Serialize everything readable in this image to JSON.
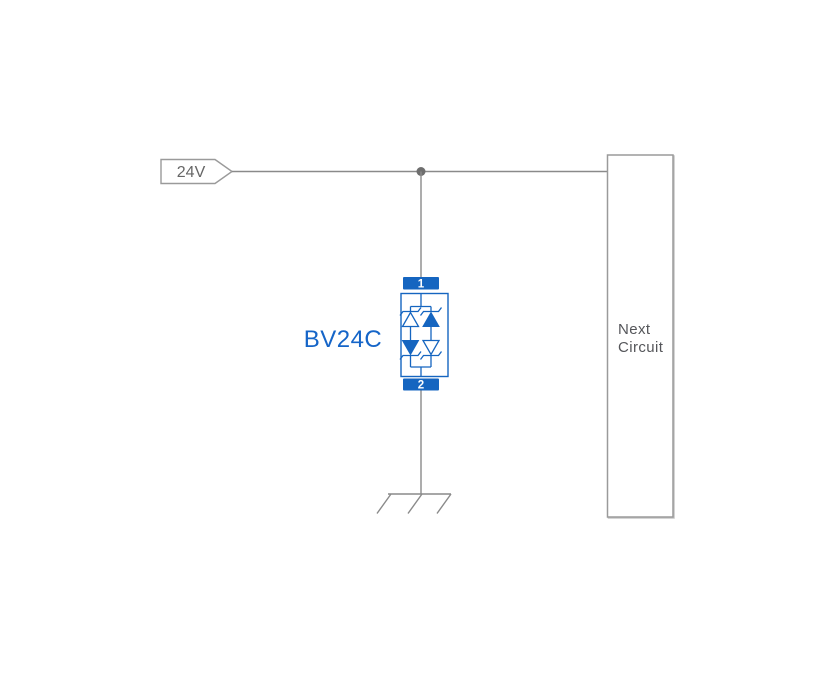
{
  "diagram": {
    "background": "#ffffff",
    "colors": {
      "wire": "#8a8a8a",
      "junction_dot": "#6e6e6e",
      "component_blue": "#1565c0",
      "label_blue": "#1565c8",
      "text_gray": "#666666",
      "box_border": "#9a9a9a",
      "box_text": "#55565a"
    },
    "source_label": {
      "text": "24V"
    },
    "component": {
      "label": "BV24C",
      "pin_top": "1",
      "pin_bottom": "2"
    },
    "next_circuit": {
      "line1": "Next",
      "line2": "Circuit"
    }
  }
}
